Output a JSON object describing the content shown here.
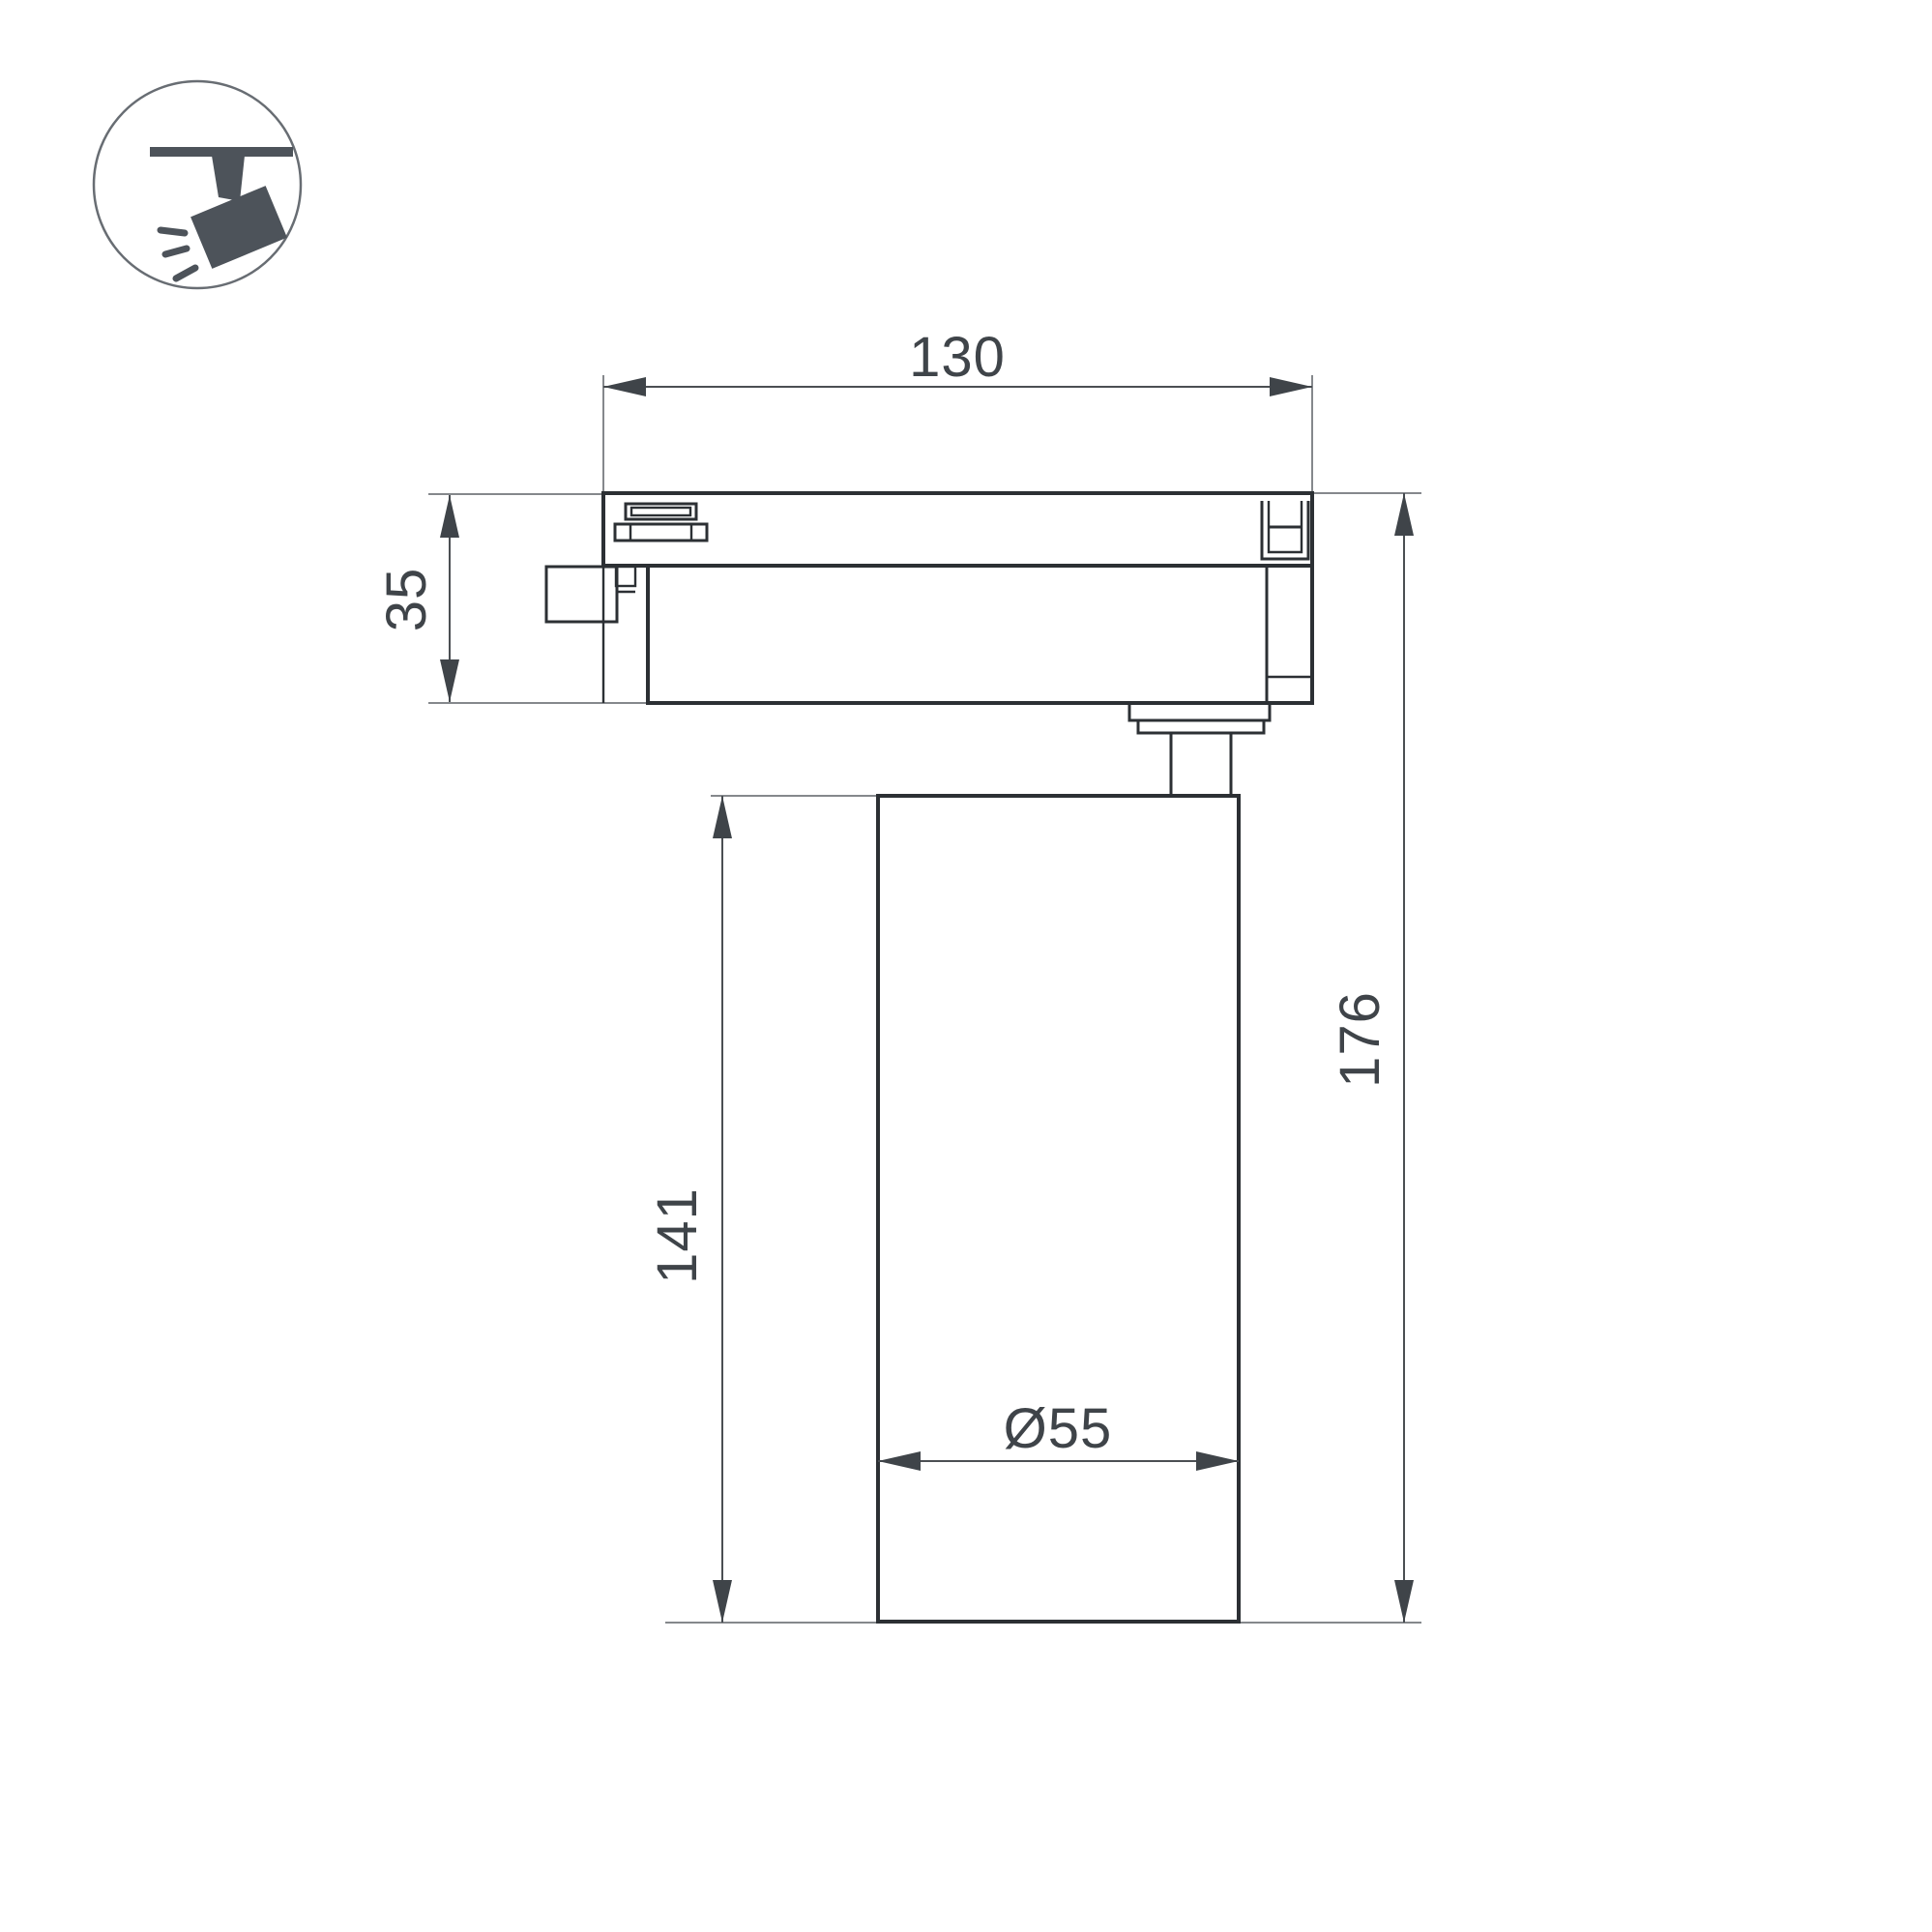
{
  "page": {
    "background": "#ffffff",
    "kind": "technical dimension drawing, track spotlight side view"
  },
  "icon": {
    "name": "track-spotlight-icon",
    "fill_color": "#4d535a",
    "ring_color": "#686d73"
  },
  "drawing": {
    "object_line_color": "#2c3034",
    "dimension_line_color": "#4b4f53",
    "extension_line_color": "#85888c",
    "text_color": "#3f4449",
    "labels": {
      "track_width": "130",
      "track_height": "35",
      "body_height": "141",
      "total_height": "176",
      "body_diameter": "Ø55"
    }
  }
}
